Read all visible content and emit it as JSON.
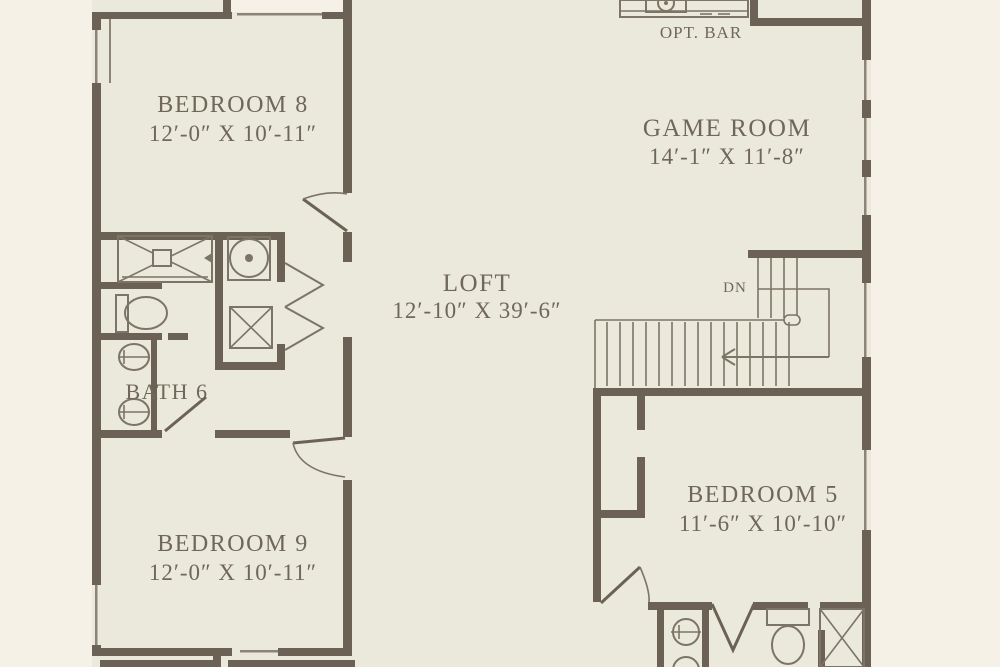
{
  "rooms": {
    "bedroom8": {
      "name": "BEDROOM 8",
      "dims": "12′-0″ X 10′-11″"
    },
    "game_room": {
      "name": "GAME ROOM",
      "dims": "14′-1″ X 11′-8″"
    },
    "loft": {
      "name": "LOFT",
      "dims": "12′-10″ X 39′-6″"
    },
    "bath6": {
      "name": "BATH 6"
    },
    "bedroom9": {
      "name": "BEDROOM 9",
      "dims": "12′-0″ X 10′-11″"
    },
    "bedroom5": {
      "name": "BEDROOM 5",
      "dims": "11′-6″ X 10′-10″"
    }
  },
  "annotations": {
    "opt_bar": "OPT. BAR",
    "stairs_down": "DN"
  },
  "symbols": [
    "shower-symbol",
    "toilet-symbol",
    "double-sink-symbol",
    "washer-symbol",
    "dryer-symbol",
    "bifold-closet-doors",
    "stairs-with-down-arrow",
    "bar-sink-symbol",
    "door-swing",
    "window-opening"
  ],
  "colors": {
    "paper": "#f6f1e6",
    "floor": "#ebe9db",
    "wall": "#6b6255",
    "line": "#7c7466",
    "text": "#6f675a"
  }
}
